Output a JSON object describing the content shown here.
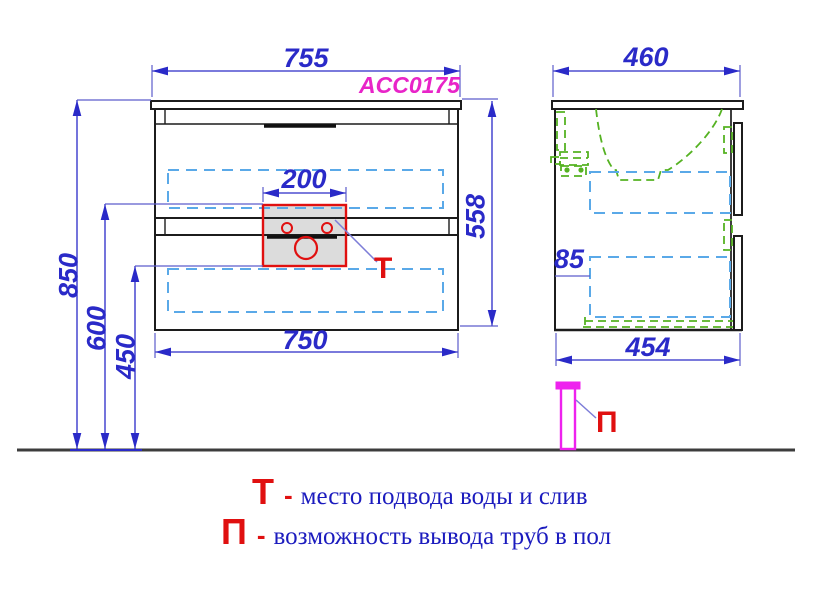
{
  "drawing": {
    "model_code": "ACC0175",
    "front_view": {
      "top_width": "755",
      "bottom_width": "750",
      "cutout_width": "200",
      "cabinet_height": "558",
      "total_height": "850",
      "supply_height": "600",
      "drain_height": "450"
    },
    "side_view": {
      "top_depth": "460",
      "bottom_depth": "454",
      "inset": "85"
    },
    "markers": {
      "t": "Т",
      "p": "П"
    },
    "legend": {
      "t_marker": "Т",
      "t_dash": "-",
      "t_text": "место подвода воды и слив",
      "p_marker": "П",
      "p_dash": "-",
      "p_text": "возможность вывода труб в пол"
    },
    "colors": {
      "dimension_blue": "#2a2ac8",
      "text_blue": "#1b1bbe",
      "dashed_blue": "#5aa9e8",
      "green": "#55b222",
      "magenta": "#ee22ee",
      "model_magenta": "#e824c8",
      "red": "#e01010",
      "line_black": "#1c1c1c"
    }
  }
}
